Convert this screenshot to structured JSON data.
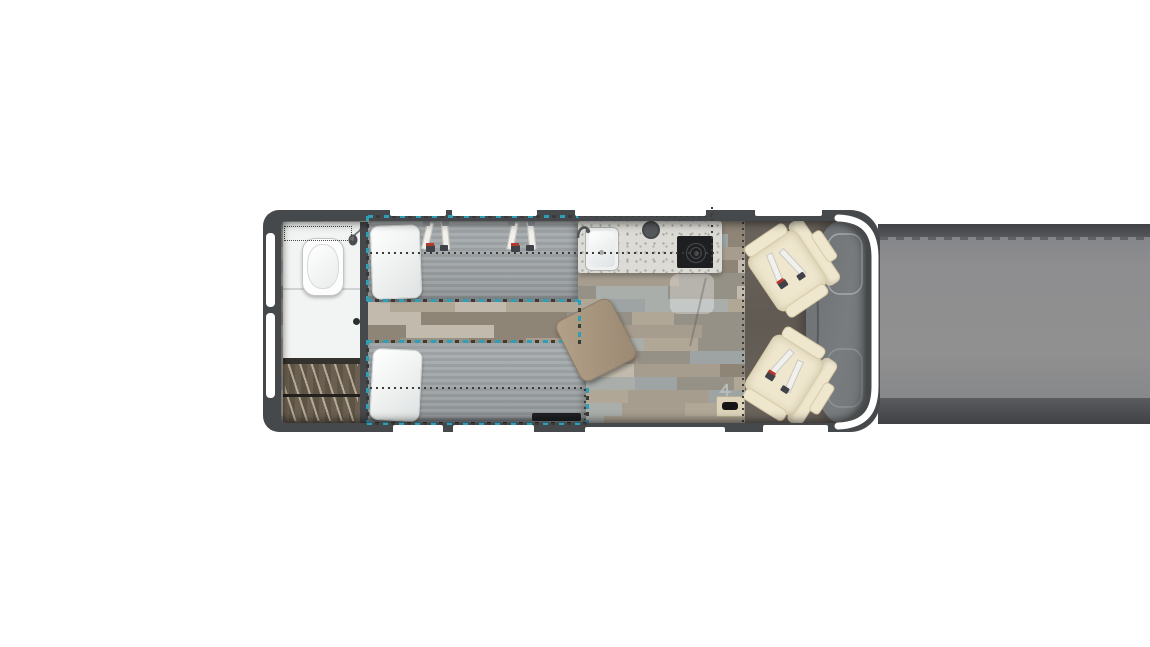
{
  "meta": {
    "content_type": "rv-camper-van-floorplan-top-view",
    "canvas": {
      "width": 1150,
      "height": 647
    },
    "notes": "no visible text in image; right side of image is a flat gray truncation band"
  },
  "colors": {
    "white": "#ffffff",
    "wall": "#46494c",
    "teal": "#2f9fb8",
    "dot": "#3a3a38",
    "bath": "#f2f3f3",
    "wardrobe-a": "#6a5f51",
    "wardrobe-b": "#5e5446",
    "mattress": "#9ea3a5",
    "counter": "#dcdbd5",
    "sink": "#eff1f1",
    "cooktop": "#1d1f21",
    "chair": "#eee6cd",
    "chair-shade": "#d6c9a6",
    "step": "#ddd4ba",
    "belt": "#f1f0ec",
    "red": "#b5382e"
  },
  "floor": {
    "wood_palette": [
      "#9da4a3",
      "#b1a796",
      "#8e8577",
      "#c2bbad",
      "#a69d8e",
      "#969186",
      "#a9aeab"
    ],
    "plank_row_height": 13
  },
  "floorplan": {
    "zones": [
      {
        "name": "rear-bathroom",
        "features": [
          "toilet",
          "shower-head-icon",
          "sliding-door-handle",
          "dotted-shower-boundary"
        ]
      },
      {
        "name": "rear-wardrobe",
        "features": [
          "hanger-rod",
          "wood-slats"
        ]
      },
      {
        "name": "twin-beds",
        "count": 2,
        "features": [
          "pillows",
          "seat-belt-pairs",
          "teal-dashed-outline",
          "dotted-centerlines",
          "under-bed-dark-bar"
        ]
      },
      {
        "name": "galley-kitchen",
        "features": [
          "sink",
          "faucet",
          "round-cover",
          "induction-cooktop",
          "speckled-countertop",
          "dotted-boundary"
        ]
      },
      {
        "name": "lounge",
        "features": [
          "pedestal-table",
          "translucent-rug",
          "entry-step",
          "fold-step-icon"
        ]
      },
      {
        "name": "cab",
        "features": [
          "swivel-chair",
          "swivel-chair",
          "hood",
          "windshield-band",
          "dotted-cab-divider"
        ]
      }
    ],
    "windows": {
      "top": 4,
      "bottom": 4,
      "rear": 2
    }
  }
}
